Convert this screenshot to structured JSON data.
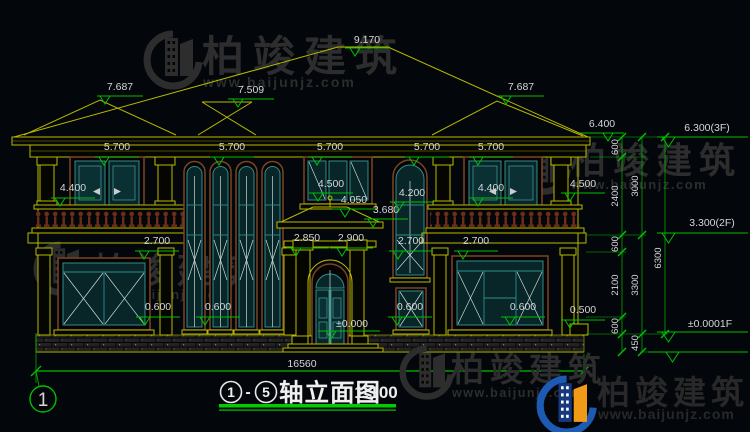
{
  "page": {
    "background": "#03060a"
  },
  "brand": {
    "name": "柏竣建筑",
    "url": "www.baijunjz.com"
  },
  "title": {
    "axis_start": "1",
    "separator": "-",
    "axis_end": "5",
    "name": "轴立面图",
    "scale": "1:100"
  },
  "axis_bubble": {
    "label": "1"
  },
  "colors": {
    "dim_green": "#00c000",
    "dim_text": "#d6d6d6",
    "wall_yellow": "#b9b900",
    "window_teal": "#2e8e8e",
    "surround_brown": "#7a4526",
    "watermark_gray": "#2d2d2d",
    "logo_blue": "#1d5ab4",
    "logo_navy": "#16387e",
    "logo_orange": "#f09a18"
  },
  "dims": {
    "total_width": "16560",
    "elevation_markers": [
      {
        "label": "9.170",
        "cx": 367,
        "ty": 43,
        "lx1": 345,
        "lx2": 389,
        "ly": 48,
        "tx": 350
      },
      {
        "label": "7.687",
        "cx": 120,
        "ty": 90,
        "lx1": 97,
        "lx2": 143,
        "ly": 96,
        "tx": 100
      },
      {
        "label": "7.509",
        "cx": 251,
        "ty": 93,
        "lx1": 228,
        "lx2": 274,
        "ly": 99,
        "tx": 233
      },
      {
        "label": "7.687",
        "cx": 521,
        "ty": 90,
        "lx1": 498,
        "lx2": 544,
        "ly": 96,
        "tx": 501
      },
      {
        "label": "6.400",
        "cx": 602,
        "ty": 127,
        "lx1": 580,
        "lx2": 624,
        "ly": 133,
        "tx": 603
      },
      {
        "label": "6.300(3F)",
        "cx": 707,
        "ty": 131,
        "lx1": 657,
        "lx2": 748,
        "ly": 137,
        "tx": 662,
        "big": true
      },
      {
        "label": "5.700",
        "cx": 117,
        "ty": 150,
        "lx1": 95,
        "lx2": 139,
        "ly": 157,
        "tx": 99
      },
      {
        "label": "5.700",
        "cx": 232,
        "ty": 150,
        "lx1": 210,
        "lx2": 254,
        "ly": 157,
        "tx": 214
      },
      {
        "label": "5.700",
        "cx": 330,
        "ty": 150,
        "lx1": 308,
        "lx2": 352,
        "ly": 157,
        "tx": 312
      },
      {
        "label": "5.700",
        "cx": 427,
        "ty": 150,
        "lx1": 405,
        "lx2": 449,
        "ly": 157,
        "tx": 409
      },
      {
        "label": "5.700",
        "cx": 491,
        "ty": 150,
        "lx1": 469,
        "lx2": 513,
        "ly": 157,
        "tx": 473
      },
      {
        "label": "4.400",
        "cx": 73,
        "ty": 191,
        "lx1": 51,
        "lx2": 95,
        "ly": 198,
        "tx": 55
      },
      {
        "label": "4.500",
        "cx": 331,
        "ty": 187,
        "lx1": 309,
        "lx2": 353,
        "ly": 193,
        "tx": 313
      },
      {
        "label": "4.050",
        "cx": 354,
        "ty": 203,
        "lx1": 332,
        "lx2": 376,
        "ly": 209,
        "tx": 340
      },
      {
        "label": "3.680",
        "cx": 386,
        "ty": 213,
        "lx1": 364,
        "lx2": 408,
        "ly": 219,
        "tx": 368
      },
      {
        "label": "4.200",
        "cx": 412,
        "ty": 196,
        "lx1": 390,
        "lx2": 434,
        "ly": 202,
        "tx": 394
      },
      {
        "label": "4.400",
        "cx": 491,
        "ty": 191,
        "lx1": 469,
        "lx2": 513,
        "ly": 198,
        "tx": 473
      },
      {
        "label": "4.500",
        "cx": 583,
        "ty": 187,
        "lx1": 561,
        "lx2": 605,
        "ly": 193,
        "tx": 565
      },
      {
        "label": "2.850",
        "cx": 307,
        "ty": 241,
        "lx1": 286,
        "lx2": 329,
        "ly": 248,
        "tx": 291
      },
      {
        "label": "2.900",
        "cx": 351,
        "ty": 241,
        "lx1": 330,
        "lx2": 373,
        "ly": 248,
        "tx": 337
      },
      {
        "label": "2.700",
        "cx": 157,
        "ty": 244,
        "lx1": 135,
        "lx2": 179,
        "ly": 251,
        "tx": 139
      },
      {
        "label": "2.700",
        "cx": 411,
        "ty": 244,
        "lx1": 389,
        "lx2": 433,
        "ly": 251,
        "tx": 393
      },
      {
        "label": "2.700",
        "cx": 476,
        "ty": 244,
        "lx1": 454,
        "lx2": 498,
        "ly": 251,
        "tx": 458
      },
      {
        "label": "0.600",
        "cx": 158,
        "ty": 310,
        "lx1": 136,
        "lx2": 180,
        "ly": 317,
        "tx": 140
      },
      {
        "label": "0.600",
        "cx": 218,
        "ty": 310,
        "lx1": 196,
        "lx2": 240,
        "ly": 317,
        "tx": 200
      },
      {
        "label": "0.600",
        "cx": 410,
        "ty": 310,
        "lx1": 388,
        "lx2": 432,
        "ly": 317,
        "tx": 392
      },
      {
        "label": "0.600",
        "cx": 523,
        "ty": 310,
        "lx1": 501,
        "lx2": 545,
        "ly": 317,
        "tx": 505
      },
      {
        "label": "0.500",
        "cx": 583,
        "ty": 313,
        "lx1": 561,
        "lx2": 605,
        "ly": 320,
        "tx": 565
      },
      {
        "label": "±0.000",
        "cx": 352,
        "ty": 327,
        "lx1": 318,
        "lx2": 380,
        "ly": 331,
        "tx": 326
      },
      {
        "label": "3.300(2F)",
        "cx": 712,
        "ty": 226,
        "lx1": 657,
        "lx2": 748,
        "ly": 233,
        "tx": 662,
        "big": true
      },
      {
        "label": "±0.0001F",
        "cx": 710,
        "ty": 327,
        "lx1": 657,
        "lx2": 748,
        "ly": 332,
        "tx": 662,
        "big": true
      },
      {
        "label": "",
        "cx": 690,
        "ty": 348,
        "lx1": 648,
        "lx2": 748,
        "ly": 352,
        "tx": 666,
        "big": true
      }
    ],
    "vertical_labels": [
      {
        "label": "600",
        "x": 618,
        "y": 147
      },
      {
        "label": "2400",
        "x": 618,
        "y": 196
      },
      {
        "label": "600",
        "x": 618,
        "y": 244
      },
      {
        "label": "2100",
        "x": 618,
        "y": 285
      },
      {
        "label": "600",
        "x": 618,
        "y": 326
      },
      {
        "label": "3000",
        "x": 638,
        "y": 186
      },
      {
        "label": "3300",
        "x": 638,
        "y": 285
      },
      {
        "label": "450",
        "x": 638,
        "y": 343
      },
      {
        "label": "6300",
        "x": 661,
        "y": 258
      }
    ]
  },
  "watermarks": {
    "instances": [
      {
        "variant": "gray",
        "layer": "under",
        "icon": {
          "x": 143,
          "y": 30,
          "s": 1.0
        },
        "cjk": {
          "x": 202,
          "y": 71,
          "fs": 42,
          "ls": 9
        },
        "url": {
          "x": 203,
          "y": 87,
          "fs": 14,
          "ls": 2
        }
      },
      {
        "variant": "gray",
        "layer": "under",
        "icon": {
          "x": 516,
          "y": 140,
          "s": 0.92
        },
        "cjk": {
          "x": 570,
          "y": 173,
          "fs": 36,
          "ls": 7
        },
        "url": {
          "x": 571,
          "y": 189,
          "fs": 13,
          "ls": 1.5
        }
      },
      {
        "variant": "gray",
        "layer": "under",
        "icon": {
          "x": 33,
          "y": 241,
          "s": 0.92
        },
        "cjk": {
          "x": 93,
          "y": 283,
          "fs": 35,
          "ls": 7
        },
        "url": {
          "x": 94,
          "y": 299,
          "fs": 13,
          "ls": 1.5
        }
      },
      {
        "variant": "gray",
        "layer": "over",
        "icon": {
          "x": 399,
          "y": 345,
          "s": 0.92
        },
        "cjk": {
          "x": 451,
          "y": 381,
          "fs": 33,
          "ls": 6
        },
        "url": {
          "x": 452,
          "y": 397,
          "fs": 12.5,
          "ls": 1.5
        }
      },
      {
        "variant": "color",
        "layer": "over",
        "icon": {
          "x": 536,
          "y": 375,
          "s": 1.02
        },
        "cjk": {
          "x": 597,
          "y": 404,
          "fs": 33,
          "ls": 5
        },
        "url": {
          "x": 598,
          "y": 419,
          "fs": 14,
          "ls": 1
        }
      }
    ]
  }
}
